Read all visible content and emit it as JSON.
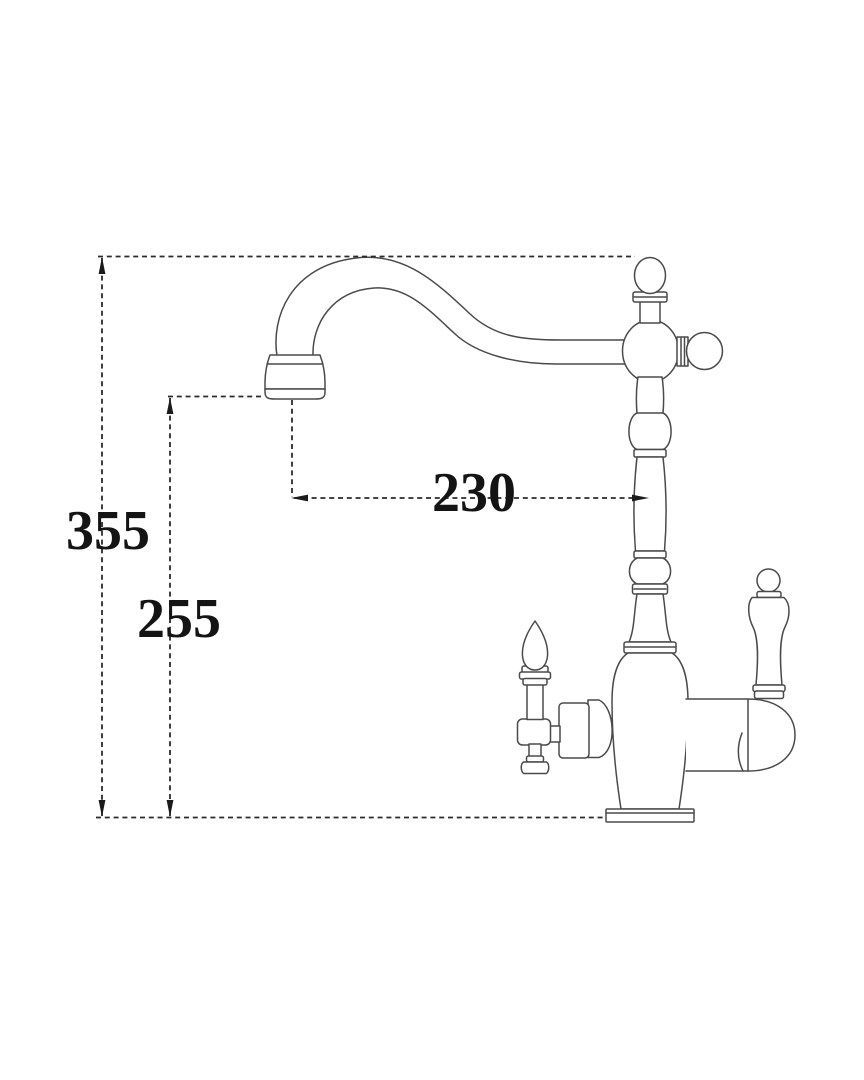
{
  "drawing": {
    "kind": "faucet-technical-dimension-drawing",
    "dimension_labels": {
      "overall_height": "355",
      "spout_outlet_height": "255",
      "spout_reach": "230"
    },
    "colors": {
      "background": "#ffffff",
      "outline": "#4a4a4a",
      "dimension_line": "#2b2b2b",
      "dimension_text": "#141414"
    }
  }
}
